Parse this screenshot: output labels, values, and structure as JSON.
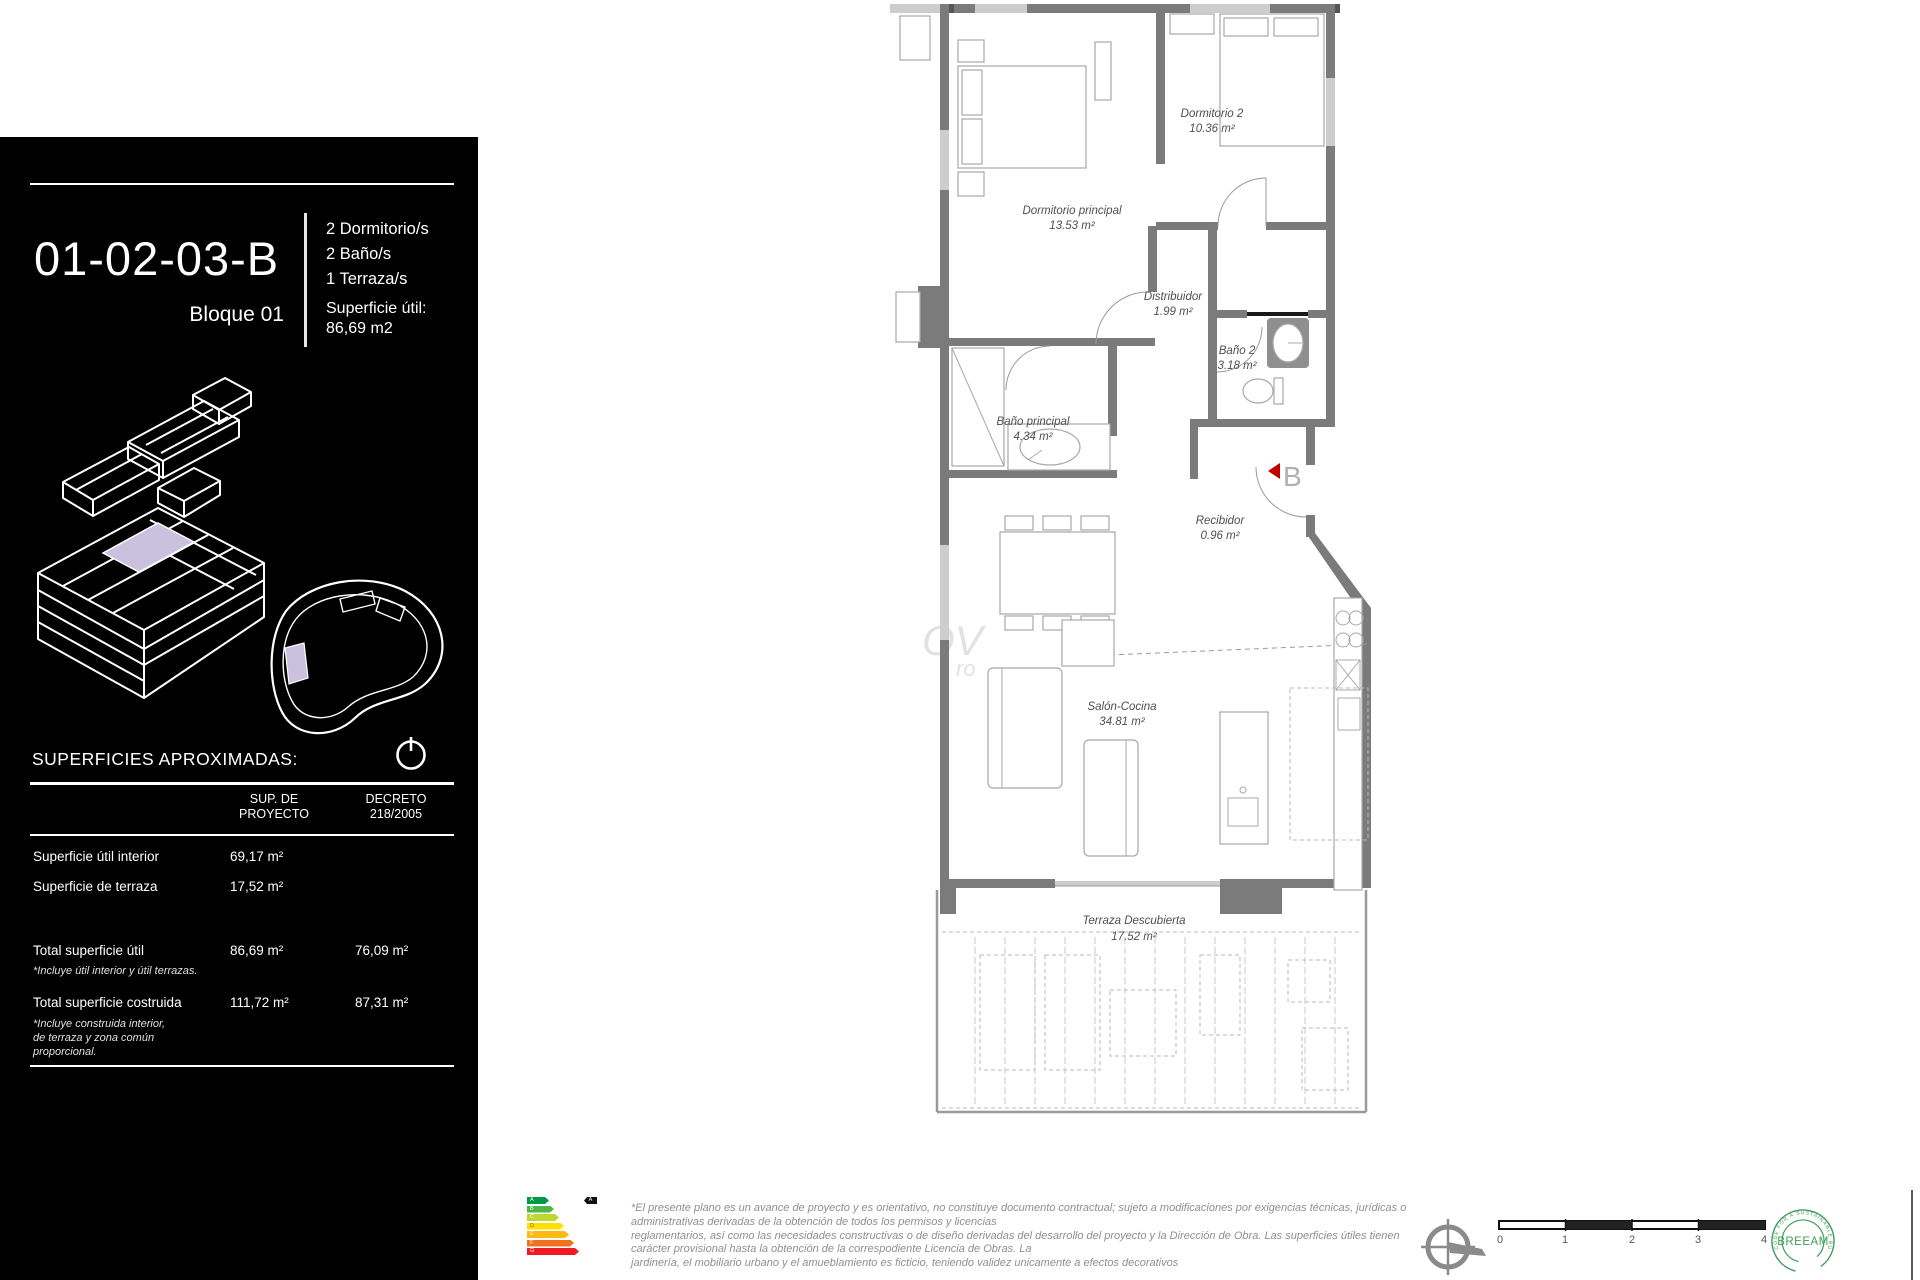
{
  "panel": {
    "unit_code": "01-02-03-B",
    "block": "Bloque 01",
    "features": [
      "2 Dormitorio/s",
      "2 Baño/s",
      "1 Terraza/s"
    ],
    "surface_label": "Superficie útil:",
    "surface_value": "86,69  m2",
    "table": {
      "heading": "SUPERFICIES APROXIMADAS:",
      "col_proyecto": "SUP. DE\nPROYECTO",
      "col_decreto": "DECRETO\n218/2005",
      "rows": [
        {
          "label": "Superficie útil interior",
          "proyecto": "69,17  m²",
          "decreto": ""
        },
        {
          "label": "Superficie de terraza",
          "proyecto": "17,52  m²",
          "decreto": ""
        },
        {
          "label": "Total superficie útil",
          "proyecto": "86,69  m²",
          "decreto": "76,09  m²",
          "note": "*Incluye útil interior y útil terrazas."
        },
        {
          "label": "Total superficie costruida",
          "proyecto": "111,72  m²",
          "decreto": "87,31  m²",
          "note": "*Incluye construida interior,\nde terraza y zona común\nproporcional."
        }
      ]
    }
  },
  "plan": {
    "rooms": {
      "dormP": {
        "name": "Dormitorio principal",
        "area": "13.53 m²"
      },
      "dorm2": {
        "name": "Dormitorio 2",
        "area": "10.36 m²"
      },
      "distrib": {
        "name": "Distribuidor",
        "area": "1.99 m²"
      },
      "bano2": {
        "name": "Baño 2",
        "area": "3.18 m²"
      },
      "banoP": {
        "name": "Baño principal",
        "area": "4.34 m²"
      },
      "recib": {
        "name": "Recibidor",
        "area": "0.96 m²"
      },
      "salon": {
        "name": "Salón-Cocina",
        "area": "34.81 m²"
      },
      "terraza": {
        "name": "Terraza Descubierta",
        "area": "17.52 m²"
      }
    },
    "entry_marker": "B",
    "watermark": {
      "line1": "OV",
      "line2": "ro"
    }
  },
  "footer": {
    "disclaimer_lines": [
      "*El presente plano es un avance de proyecto y es orientativo, no constituye documento contractual; sujeto a modificaciones por exigencias técnicas, jurídicas o",
      "administrativas derivadas de la obtención de todos los permisos y licencias",
      "reglamentarios, así como las necesidades constructivas o de diseño derivadas del desarrollo del proyecto y la Dirección de Obra. Las superficies útiles tienen",
      "carácter provisional hasta la obtención de la correspodiente Licencia de Obras. La",
      "jardinería, el mobiliario urbano y el amueblamiento es ficticio, teniendo validez unicamente a efectos decorativos"
    ],
    "scale_ticks": [
      "0",
      "1",
      "2",
      "3",
      "4"
    ],
    "energy": {
      "letters": [
        "A",
        "B",
        "C",
        "D",
        "E",
        "F",
        "G"
      ],
      "rating": "A"
    },
    "breeam": {
      "label": "BREEAM",
      "ring_text": "CODE FOR A SUSTAINABLE BUILT ENVIRONMENT"
    }
  },
  "colors": {
    "accent_lavender": "#c9c1dd",
    "marker_red": "#c00000",
    "breeam_green": "#3f9c5a"
  }
}
